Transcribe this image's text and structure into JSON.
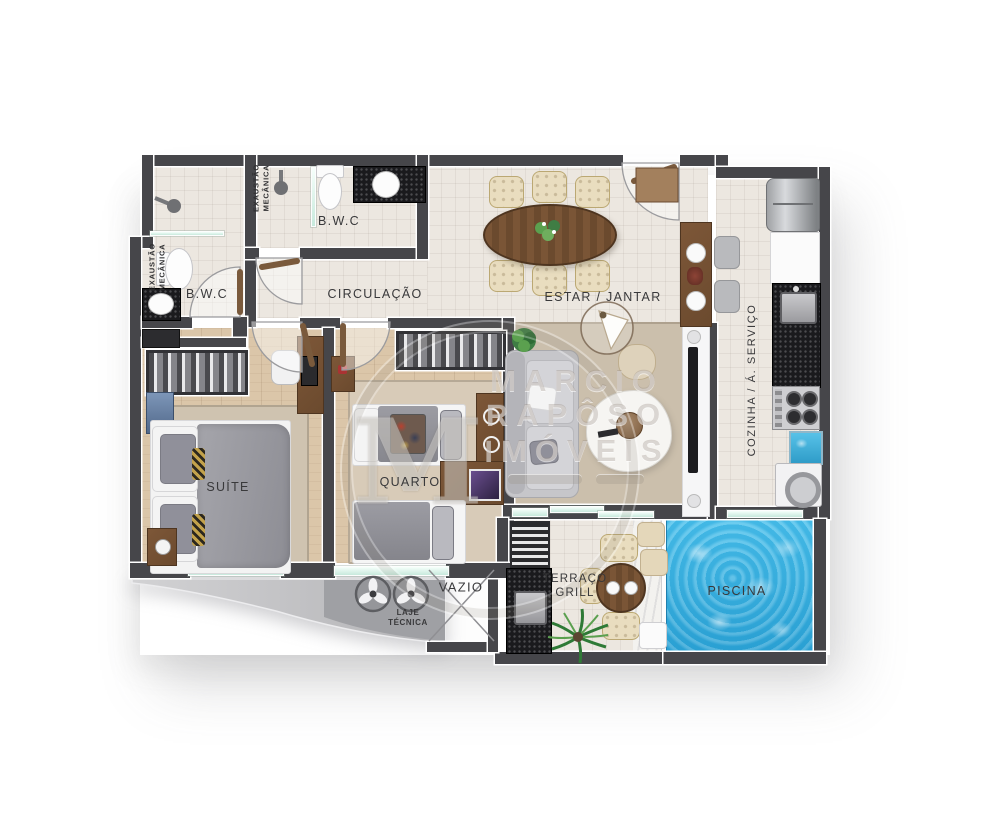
{
  "floorplan": {
    "title": "apartment floor plan",
    "labels": {
      "bwc_left": "B.W.C",
      "bwc_top": "B.W.C",
      "circulacao": "CIRCULAÇÃO",
      "estar_jantar": "ESTAR / JANTAR",
      "cozinha_servico": "COZINHA / Á. SERVIÇO",
      "suite": "SUÍTE",
      "quarto": "QUARTO",
      "vazio": "VAZIO",
      "laje_line1": "LAJE",
      "laje_line2": "TÉCNICA",
      "terraco_line1": "TERRAÇO",
      "terraco_line2": "GRILL",
      "piscina": "PISCINA",
      "exaustao_line1": "EXAUSTÃO",
      "exaustao_line2": "MECÂNICA"
    },
    "watermark": {
      "monogram": "M",
      "line1": "MARCIO",
      "line2": "RAPÔSO",
      "line3": "IMÓVEIS"
    },
    "colors": {
      "wall": "#46464a",
      "tile_floor": "#ece7e0",
      "wood_floor": "#dbc6a9",
      "rug": "#cdc1ae",
      "pool_water": "#3eb5e6",
      "granite": "#1a1a1d",
      "wood_furniture": "#6f4c31",
      "chair_beige": "#e9ddbf",
      "glass": "#c7e9dc",
      "slab": "#bfbfc2"
    }
  }
}
